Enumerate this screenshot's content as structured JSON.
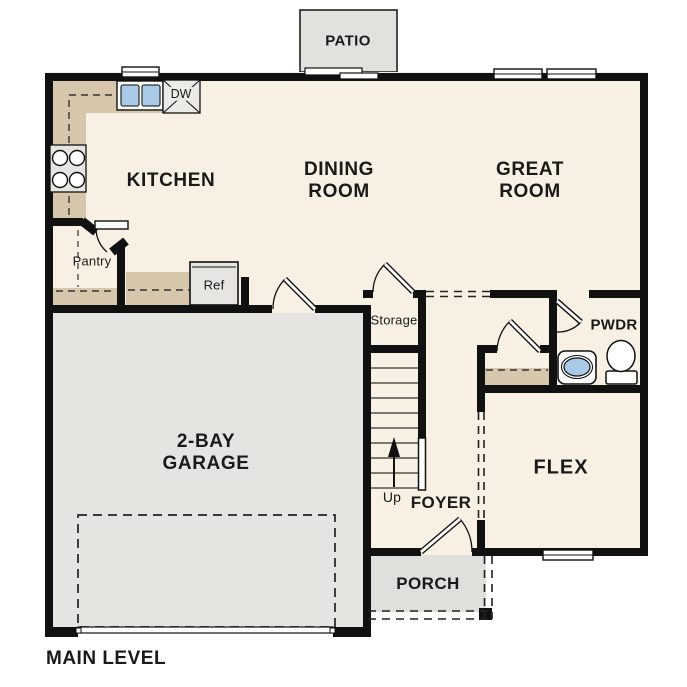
{
  "plan": {
    "title": "MAIN LEVEL",
    "rooms": {
      "kitchen": "KITCHEN",
      "dining": {
        "line1": "DINING",
        "line2": "ROOM"
      },
      "great": {
        "line1": "GREAT",
        "line2": "ROOM"
      },
      "garage": {
        "line1": "2-BAY",
        "line2": "GARAGE"
      },
      "flex": "FLEX",
      "foyer": "FOYER",
      "pwdr": "PWDR",
      "patio": "PATIO",
      "porch": "PORCH",
      "storage": "Storage",
      "pantry": "Pantry"
    },
    "fixtures": {
      "refrigerator": "Ref",
      "dishwasher": "DW",
      "stairs_direction": "Up"
    },
    "colors": {
      "wall": "#111111",
      "floor": "#f8f1e3",
      "garage_floor": "#e6e4e1",
      "counter": "#d5c6ac",
      "outdoor_concrete": "#e2e1dd",
      "porch_floor": "#e0dfdb",
      "sink_blue": "#a9c9e8",
      "text": "#1a1a1a"
    }
  }
}
